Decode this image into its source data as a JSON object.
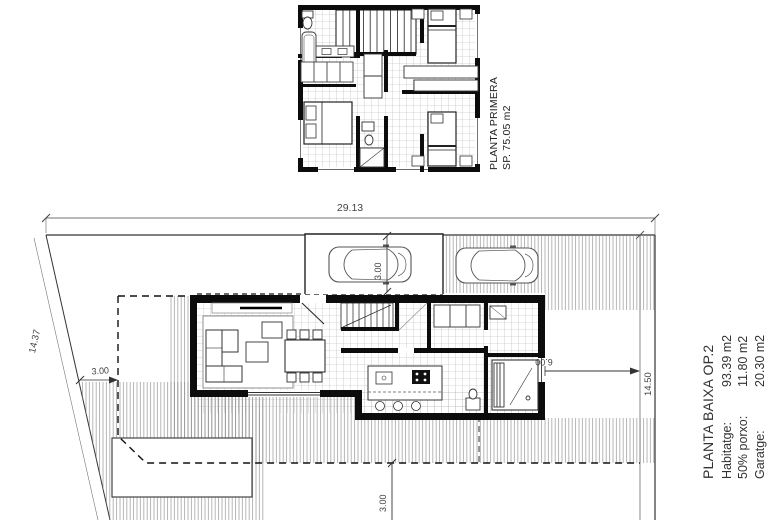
{
  "upper_plan": {
    "title": "PLANTA PRIMERA",
    "area": "SP. 75.05 m2"
  },
  "site_plan": {
    "title": "PLANTA BAIXA OP.2",
    "legend": [
      {
        "label": "Habitatge:",
        "value": "93.39 m2"
      },
      {
        "label": "50% porxo:",
        "value": "11.80 m2"
      },
      {
        "label": "Garatge:",
        "value": "20.30 m2"
      }
    ],
    "dimensions": {
      "plot_width": "29.13",
      "plot_depth_left": "14.37",
      "plot_depth_right": "14.50",
      "garage_bay": "3.00",
      "side_setback": "3.00",
      "rear_setback": "3.00",
      "right_yard": "6.00"
    }
  },
  "colors": {
    "ink": "#1a1a1a",
    "hatch": "#808080",
    "tile": "#b0b0b0"
  }
}
